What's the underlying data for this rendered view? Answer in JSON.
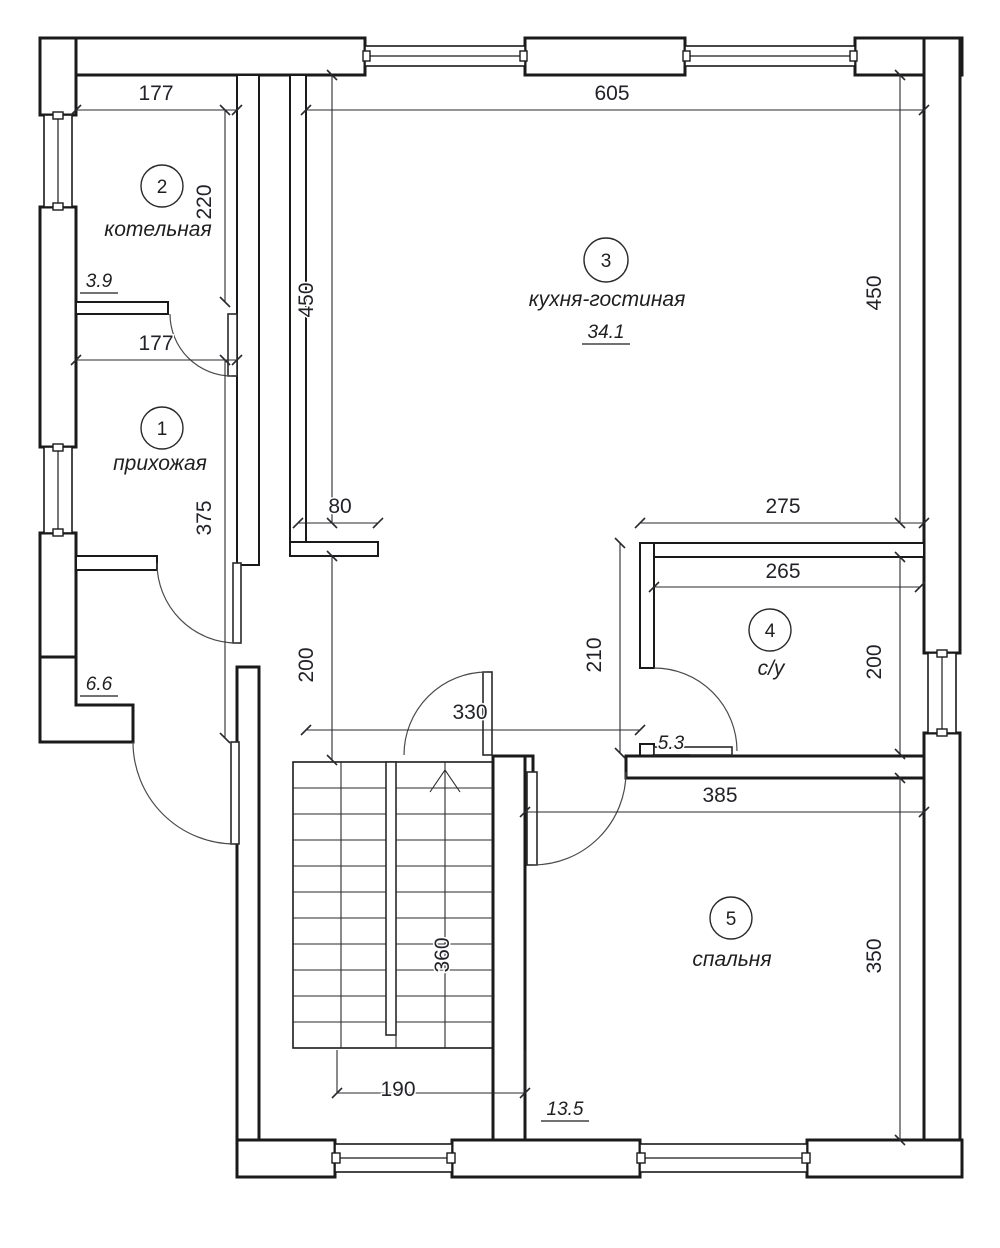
{
  "drawing": {
    "background": "#ffffff",
    "line_color": "#1a1a1a",
    "dim_text_color": "#222228"
  },
  "rooms": [
    {
      "number": "1",
      "name": "прихожая",
      "area": "6.6"
    },
    {
      "number": "2",
      "name": "котельная",
      "area": "3.9"
    },
    {
      "number": "3",
      "name": "кухня-гостиная",
      "area": "34.1"
    },
    {
      "number": "4",
      "name": "с/у",
      "area": "5.3"
    },
    {
      "number": "5",
      "name": "спальня",
      "area": "13.5"
    }
  ],
  "dimensions": {
    "boiler_width": "177",
    "boiler_depth": "220",
    "kitchen_width": "605",
    "kitchen_depth_left": "450",
    "kitchen_depth_right": "450",
    "hall_width": "177",
    "hall_depth": "375",
    "niche_width": "80",
    "bath_offset": "275",
    "bath_width": "265",
    "stair_hall_depth": "200",
    "bath_depth_left": "210",
    "bath_depth_right": "200",
    "corridor_width": "330",
    "bedroom_width": "385",
    "bedroom_depth": "350",
    "stair_run": "360",
    "stair_landing_width": "190"
  }
}
